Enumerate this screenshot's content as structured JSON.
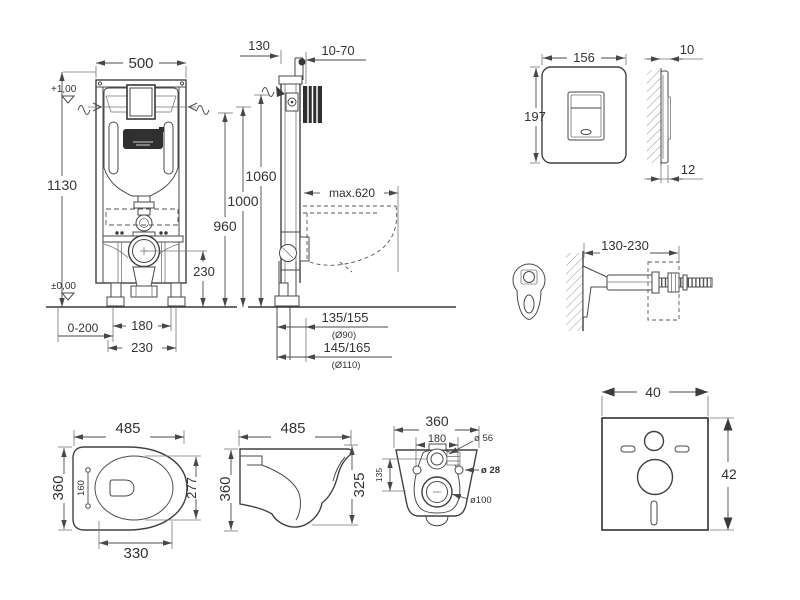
{
  "meta": {
    "drawing_type": "wall-hung WC installation frame technical drawing"
  },
  "colors": {
    "line": "#414141",
    "dimension": "#4a4a4a",
    "text": "#333333",
    "badge": "#2f2f2f",
    "wall_section": "#2f2f2f",
    "background": "#ffffff"
  },
  "views": {
    "frame_front": {
      "logo": "GROHE",
      "dims": {
        "width": "500",
        "height": "1130",
        "level_top": "+1,00",
        "level_floor": "±0,00",
        "feet_range": "0-200",
        "rod_spacing": "180",
        "base_width": "230",
        "outlet_height": "230"
      }
    },
    "frame_side": {
      "dims": {
        "depth": "130",
        "wall_distance": "10-70",
        "height_1": "960",
        "height_2": "1000",
        "height_3": "1060",
        "max_depth": "max.620",
        "drain_row1": "135/155",
        "drain_row1_dia": "(Ø90)",
        "drain_row2": "145/165",
        "drain_row2_dia": "(Ø110)"
      }
    },
    "flush_plate": {
      "dims": {
        "width": "156",
        "height": "197",
        "thickness_top": "10",
        "thickness_bottom": "12"
      }
    },
    "wall_bracket": {
      "dims": {
        "range": "130-230"
      }
    },
    "toilet_top": {
      "dims": {
        "length": "485",
        "width": "360",
        "bolt_gauge": "160",
        "seat_length": "277",
        "front_width": "330"
      }
    },
    "toilet_side": {
      "dims": {
        "length": "485",
        "height": "360",
        "front_height": "325"
      }
    },
    "toilet_rear": {
      "dims": {
        "width": "360",
        "bolt_spacing": "180",
        "inlet_dia": "ø 56",
        "bolt_dia": "ø 28",
        "vertical_offset": "135",
        "outlet_dia": "ø100"
      }
    },
    "sound_mat": {
      "dims": {
        "width": "40",
        "height": "42"
      }
    }
  }
}
